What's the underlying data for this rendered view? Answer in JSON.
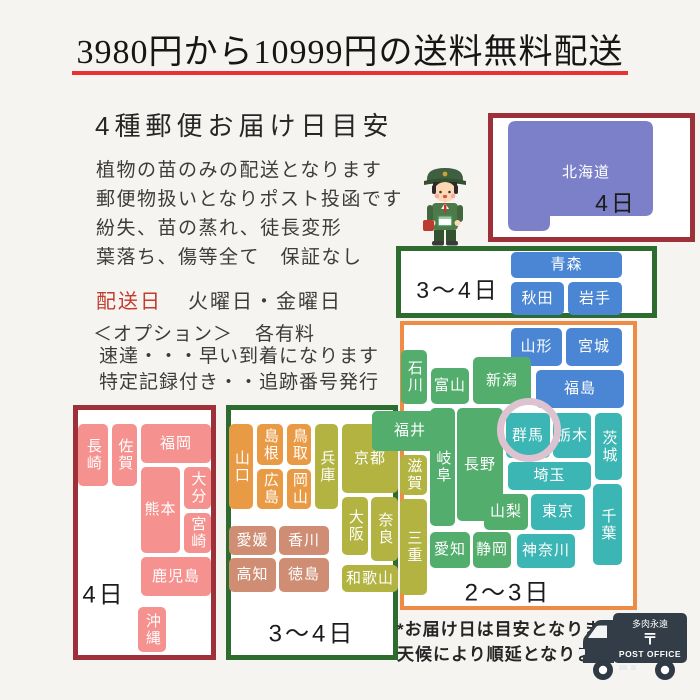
{
  "title": {
    "text": "3980円から10999円の送料無料配送",
    "underline_color": "#e63232"
  },
  "info": {
    "heading": "4種郵便お届け日目安",
    "lines": [
      "植物の苗のみの配送となります",
      "郵便物扱いとなりポスト投函です",
      "紛失、苗の蒸れ、徒長変形",
      "葉落ち、傷等全て　保証なし"
    ],
    "delivery_label": "配送日",
    "delivery_days": "火曜日・金曜日",
    "option_label": "＜オプション＞",
    "option_note": "各有料",
    "option_lines": [
      "速達・・・早い到着になります",
      "特定記録付き・・追跡番号発行"
    ]
  },
  "footer": {
    "notes": [
      "*お届け日は目安となります",
      "天候により順延となります"
    ]
  },
  "truck": {
    "line1": "多肉永遠",
    "line2": "〒",
    "line3": "POST OFFICE"
  },
  "map": {
    "hokkaido_label": "北海道",
    "hokkaido_fill": "#7b80c8",
    "boxes": [
      {
        "id": "hokkaido-frame",
        "border_color": "#9e3039",
        "border_w": 5,
        "x": 488,
        "y": 113,
        "w": 207,
        "h": 129,
        "label": {
          "text": "4日",
          "x": 616,
          "y": 201,
          "size": 23
        }
      },
      {
        "id": "tohoku-frame",
        "border_color": "#2e6b2e",
        "border_w": 5,
        "x": 396,
        "y": 246,
        "w": 261,
        "h": 72,
        "label": {
          "text": "3〜4日",
          "x": 458,
          "y": 288,
          "size": 23
        }
      },
      {
        "id": "honshu-frame",
        "border_color": "#ee8c45",
        "border_w": 4,
        "x": 400,
        "y": 321,
        "w": 237,
        "h": 289,
        "label": {
          "text": "2〜3日",
          "x": 508,
          "y": 590,
          "size": 24
        }
      },
      {
        "id": "west-frame",
        "border_color": "#2e6b2e",
        "border_w": 5,
        "x": 226,
        "y": 405,
        "w": 172,
        "h": 255,
        "label": {
          "text": "3〜4日",
          "x": 312,
          "y": 631,
          "size": 24
        }
      },
      {
        "id": "kyushu-frame",
        "border_color": "#9e3039",
        "border_w": 5,
        "x": 73,
        "y": 405,
        "w": 143,
        "h": 255,
        "label": {
          "text": "4日",
          "x": 104,
          "y": 592,
          "size": 24
        }
      }
    ],
    "tiles": [
      {
        "id": "aomori",
        "label": "青森",
        "x": 511,
        "y": 252,
        "w": 111,
        "h": 26,
        "color": "#4a86d3"
      },
      {
        "id": "akita",
        "label": "秋田",
        "x": 511,
        "y": 282,
        "w": 53,
        "h": 33,
        "color": "#4a86d3"
      },
      {
        "id": "iwate",
        "label": "岩手",
        "x": 568,
        "y": 282,
        "w": 54,
        "h": 33,
        "color": "#4a86d3"
      },
      {
        "id": "yamagata",
        "label": "山形",
        "x": 511,
        "y": 328,
        "w": 51,
        "h": 38,
        "color": "#4a86d3"
      },
      {
        "id": "miyagi",
        "label": "宮城",
        "x": 566,
        "y": 328,
        "w": 56,
        "h": 38,
        "color": "#4a86d3"
      },
      {
        "id": "fukushima",
        "label": "福島",
        "x": 536,
        "y": 370,
        "w": 88,
        "h": 38,
        "color": "#4a86d3"
      },
      {
        "id": "ishikawa",
        "label": "石川",
        "x": 401,
        "y": 350,
        "w": 26,
        "h": 54,
        "color": "#53ae6d",
        "vertical": true
      },
      {
        "id": "toyama",
        "label": "富山",
        "x": 431,
        "y": 368,
        "w": 38,
        "h": 36,
        "color": "#53ae6d"
      },
      {
        "id": "niigata",
        "label": "新潟",
        "x": 473,
        "y": 357,
        "w": 58,
        "h": 47,
        "color": "#53ae6d"
      },
      {
        "id": "nagano",
        "label": "長野",
        "x": 457,
        "y": 408,
        "w": 46,
        "h": 113,
        "color": "#53ae6d"
      },
      {
        "id": "gifu",
        "label": "岐阜",
        "x": 430,
        "y": 408,
        "w": 25,
        "h": 118,
        "color": "#53ae6d",
        "vertical": true
      },
      {
        "id": "yamanashi",
        "label": "山梨",
        "x": 484,
        "y": 494,
        "w": 44,
        "h": 36,
        "color": "#53ae6d"
      },
      {
        "id": "aichi",
        "label": "愛知",
        "x": 430,
        "y": 532,
        "w": 40,
        "h": 36,
        "color": "#53ae6d"
      },
      {
        "id": "shizuoka",
        "label": "静岡",
        "x": 473,
        "y": 532,
        "w": 38,
        "h": 36,
        "color": "#53ae6d"
      },
      {
        "id": "gunma",
        "label": "群馬",
        "x": 506,
        "y": 413,
        "w": 44,
        "h": 45,
        "color": "#3bb6b4"
      },
      {
        "id": "tochigi",
        "label": "栃木",
        "x": 553,
        "y": 413,
        "w": 38,
        "h": 45,
        "color": "#3bb6b4"
      },
      {
        "id": "ibaraki",
        "label": "茨城",
        "x": 595,
        "y": 413,
        "w": 27,
        "h": 67,
        "color": "#3bb6b4",
        "vertical": true
      },
      {
        "id": "saitama",
        "label": "埼玉",
        "x": 508,
        "y": 462,
        "w": 83,
        "h": 28,
        "color": "#3bb6b4"
      },
      {
        "id": "tokyo",
        "label": "東京",
        "x": 531,
        "y": 494,
        "w": 54,
        "h": 36,
        "color": "#3bb6b4"
      },
      {
        "id": "kanagawa",
        "label": "神奈川",
        "x": 517,
        "y": 534,
        "w": 58,
        "h": 34,
        "color": "#3bb6b4"
      },
      {
        "id": "chiba",
        "label": "千葉",
        "x": 593,
        "y": 484,
        "w": 29,
        "h": 81,
        "color": "#3bb6b4",
        "vertical": true
      },
      {
        "id": "shiga",
        "label": "滋賀",
        "x": 400,
        "y": 455,
        "w": 27,
        "h": 40,
        "color": "#b2b340",
        "vertical": true
      },
      {
        "id": "mie",
        "label": "三重",
        "x": 400,
        "y": 499,
        "w": 27,
        "h": 96,
        "color": "#b2b340",
        "vertical": true
      },
      {
        "id": "yamaguchi",
        "label": "山口",
        "x": 229,
        "y": 424,
        "w": 24,
        "h": 85,
        "color": "#e99a44",
        "vertical": true
      },
      {
        "id": "shimane",
        "label": "島根",
        "x": 257,
        "y": 424,
        "w": 26,
        "h": 41,
        "color": "#e99a44",
        "vertical": true
      },
      {
        "id": "tottori",
        "label": "鳥取",
        "x": 287,
        "y": 424,
        "w": 24,
        "h": 41,
        "color": "#e99a44",
        "vertical": true
      },
      {
        "id": "hiroshima",
        "label": "広島",
        "x": 257,
        "y": 469,
        "w": 26,
        "h": 40,
        "color": "#e99a44",
        "vertical": true
      },
      {
        "id": "okayama",
        "label": "岡山",
        "x": 287,
        "y": 469,
        "w": 24,
        "h": 40,
        "color": "#e99a44",
        "vertical": true
      },
      {
        "id": "hyogo",
        "label": "兵庫",
        "x": 315,
        "y": 424,
        "w": 23,
        "h": 85,
        "color": "#b2b340",
        "vertical": true
      },
      {
        "id": "kyoto",
        "label": "京都",
        "x": 342,
        "y": 424,
        "w": 56,
        "h": 69,
        "color": "#b2b340"
      },
      {
        "id": "osaka",
        "label": "大阪",
        "x": 342,
        "y": 497,
        "w": 26,
        "h": 58,
        "color": "#b2b340",
        "vertical": true
      },
      {
        "id": "nara",
        "label": "奈良",
        "x": 371,
        "y": 497,
        "w": 27,
        "h": 64,
        "color": "#b2b340",
        "vertical": true
      },
      {
        "id": "wakayama",
        "label": "和歌山",
        "x": 342,
        "y": 565,
        "w": 56,
        "h": 27,
        "color": "#b2b340"
      },
      {
        "id": "ehime",
        "label": "愛媛",
        "x": 229,
        "y": 526,
        "w": 47,
        "h": 29,
        "color": "#cf8d74"
      },
      {
        "id": "kagawa",
        "label": "香川",
        "x": 279,
        "y": 526,
        "w": 50,
        "h": 29,
        "color": "#cf8d74"
      },
      {
        "id": "kochi",
        "label": "高知",
        "x": 229,
        "y": 558,
        "w": 47,
        "h": 34,
        "color": "#cf8d74"
      },
      {
        "id": "tokushima",
        "label": "徳島",
        "x": 279,
        "y": 558,
        "w": 50,
        "h": 34,
        "color": "#cf8d74"
      },
      {
        "id": "nagasaki",
        "label": "長崎",
        "x": 78,
        "y": 424,
        "w": 30,
        "h": 62,
        "color": "#f5918e",
        "vertical": true
      },
      {
        "id": "saga",
        "label": "佐賀",
        "x": 112,
        "y": 424,
        "w": 25,
        "h": 62,
        "color": "#f5918e",
        "vertical": true
      },
      {
        "id": "fukuoka",
        "label": "福岡",
        "x": 141,
        "y": 424,
        "w": 70,
        "h": 39,
        "color": "#f5918e"
      },
      {
        "id": "oita",
        "label": "大分",
        "x": 184,
        "y": 467,
        "w": 27,
        "h": 42,
        "color": "#f5918e",
        "vertical": true
      },
      {
        "id": "miyazaki",
        "label": "宮崎",
        "x": 184,
        "y": 513,
        "w": 27,
        "h": 40,
        "color": "#f5918e",
        "vertical": true
      },
      {
        "id": "kumamoto",
        "label": "熊本",
        "x": 141,
        "y": 467,
        "w": 39,
        "h": 86,
        "color": "#f5918e"
      },
      {
        "id": "kagoshima",
        "label": "鹿児島",
        "x": 141,
        "y": 557,
        "w": 70,
        "h": 39,
        "color": "#f5918e"
      },
      {
        "id": "okinawa",
        "label": "沖縄",
        "x": 138,
        "y": 607,
        "w": 28,
        "h": 45,
        "color": "#f5918e",
        "vertical": true
      },
      {
        "id": "fukui",
        "label": "福井",
        "x": 372,
        "y": 411,
        "w": 76,
        "h": 40,
        "color": "#53ae6d"
      }
    ],
    "ring": {
      "x": 497,
      "y": 398,
      "d": 64,
      "stroke": 7,
      "color": "#dcc3cf"
    }
  }
}
